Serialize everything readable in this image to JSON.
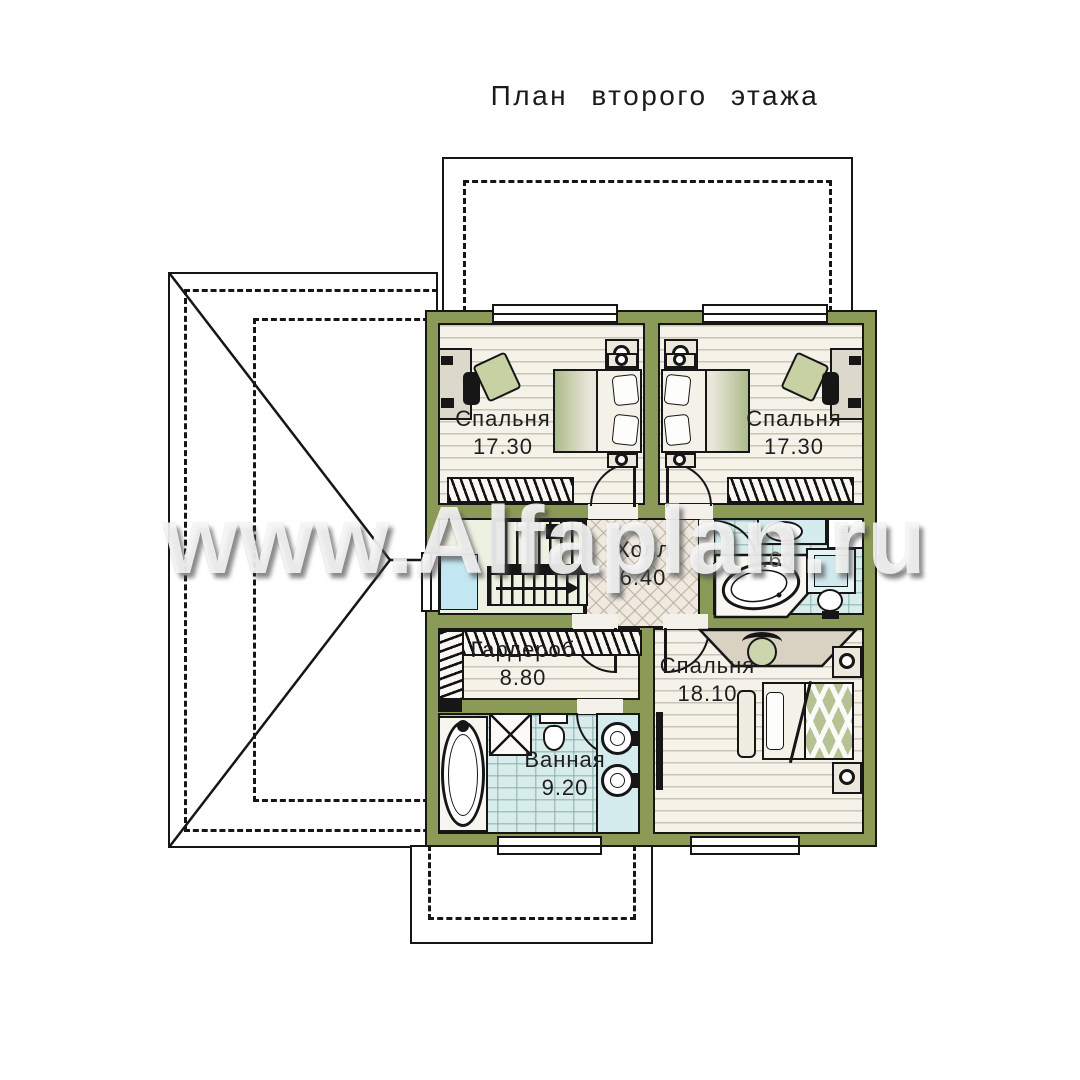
{
  "title": "План второго этажа",
  "watermark": "www.Alfaplan.ru",
  "rooms": {
    "bedroom1": {
      "name": "Спальня",
      "area": "17.30"
    },
    "bedroom2": {
      "name": "Спальня",
      "area": "17.30"
    },
    "hall": {
      "name": "Холл",
      "area": "6.40"
    },
    "bathroom_top": {
      "area": "6.60"
    },
    "wardrobe": {
      "name": "Гардероб",
      "area": "8.80"
    },
    "bathroom_main": {
      "name": "Ванная",
      "area": "9.20"
    },
    "bedroom3": {
      "name": "Спальня",
      "area": "18.10"
    }
  },
  "appliances": {
    "washing_machine": "стм"
  },
  "colors": {
    "wall": "#8b9a57",
    "floor_wood": "#f5f2ea",
    "floor_tile_blue": "#d8eceb",
    "floor_tile_hall": "#efe9e0",
    "stair_floor": "#edf1e2",
    "window_glass": "#c3e7f2"
  }
}
